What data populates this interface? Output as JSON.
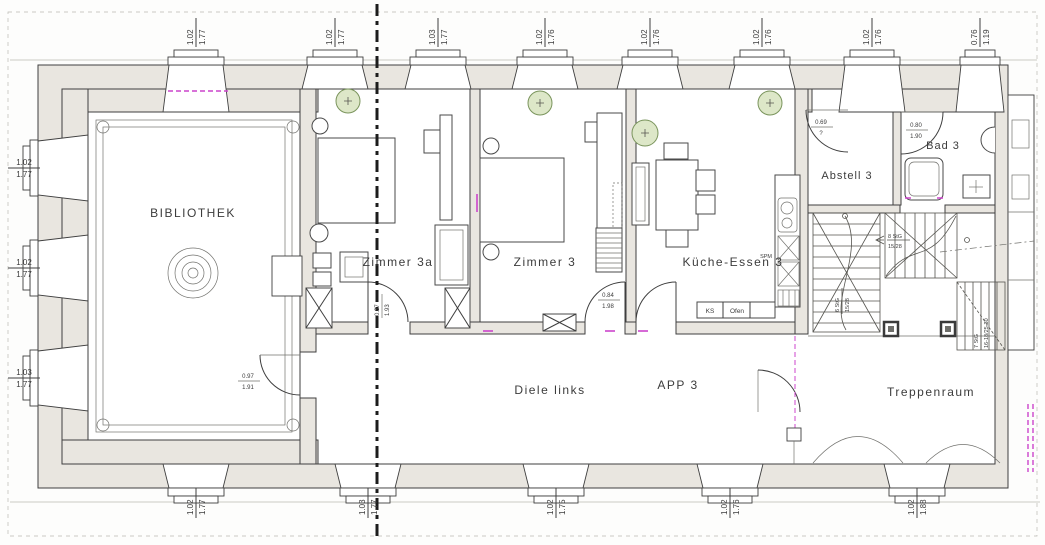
{
  "labels": {
    "bibliothek": "BIBLIOTHEK",
    "zimmer3a": "Zimmer 3a",
    "zimmer3": "Zimmer 3",
    "kueche": "Küche-Essen 3",
    "abstell": "Abstell 3",
    "bad": "Bad 3",
    "diele": "Diele links",
    "app3": "APP 3",
    "treppenraum": "Treppenraum"
  },
  "kitchen": {
    "ks": "KS",
    "ofen": "Ofen",
    "spm": "SPM"
  },
  "stairs": {
    "flight_left": {
      "steps": "6 StG",
      "ratio": "15/28"
    },
    "flight_top": {
      "steps": "8 StG",
      "ratio": "15/28"
    },
    "flight_right": {
      "steps": "7 StG",
      "ratio": "16-18/25-30"
    }
  },
  "door_dims": {
    "bibliothek": {
      "w": "0.97",
      "h": "1.91"
    },
    "zimmer3a": {
      "w": "0.87",
      "h": "1.93"
    },
    "zimmer3": {
      "w": "0.84",
      "h": "1.98"
    },
    "abstell": {
      "w": "0.69",
      "h": "?"
    },
    "bad": {
      "w": "0.80",
      "h": "1.90"
    }
  },
  "window_dims": {
    "top": [
      {
        "w": "1.02",
        "h": "1.77"
      },
      {
        "w": "1.02",
        "h": "1.77"
      },
      {
        "w": "1.03",
        "h": "1.77"
      },
      {
        "w": "1.02",
        "h": "1.76"
      },
      {
        "w": "1.02",
        "h": "1.76"
      },
      {
        "w": "1.02",
        "h": "1.76"
      },
      {
        "w": "1.02",
        "h": "1.76"
      },
      {
        "w": "0.76",
        "h": "1.19"
      }
    ],
    "left": [
      {
        "w": "1.02",
        "h": "1.77"
      },
      {
        "w": "1.02",
        "h": "1.77"
      },
      {
        "w": "1.03",
        "h": "1.77"
      }
    ],
    "bottom": [
      {
        "w": "1.02",
        "h": "1.77"
      },
      {
        "w": "1.03",
        "h": "1.77"
      },
      {
        "w": "1.02",
        "h": "1.75"
      },
      {
        "w": "1.02",
        "h": "1.76"
      },
      {
        "w": "1.02",
        "h": "1.88"
      }
    ]
  },
  "colors": {
    "wall_fill": "#e9e6e0",
    "line": "#3f3f3f",
    "plant_fill": "#dde7c8",
    "plant_stroke": "#7a945c",
    "magenta": "#cc44cc",
    "text": "#3c3c3c"
  }
}
